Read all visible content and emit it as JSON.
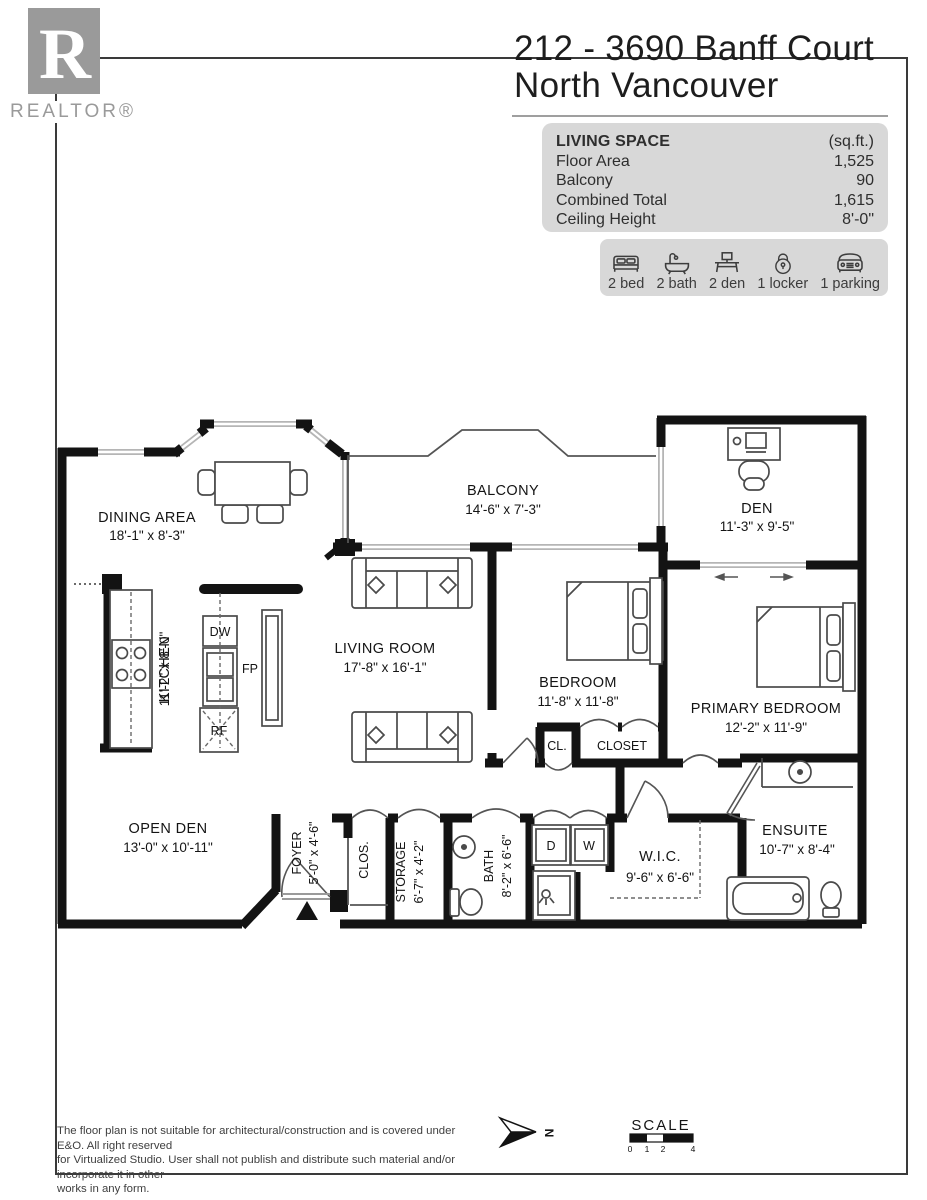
{
  "logo": {
    "text": "REALTOR®",
    "letter": "R"
  },
  "header": {
    "title_line1": "212 - 3690 Banff Court",
    "title_line2": "North Vancouver"
  },
  "living_space": {
    "title": "LIVING SPACE",
    "unit": "(sq.ft.)",
    "rows": [
      {
        "label": "Floor Area",
        "value": "1,525"
      },
      {
        "label": "Balcony",
        "value": "90"
      },
      {
        "label": "Combined Total",
        "value": "1,615"
      },
      {
        "label": "Ceiling Height",
        "value": "8'-0\""
      }
    ]
  },
  "features": [
    {
      "icon": "bed-icon",
      "label": "2 bed"
    },
    {
      "icon": "bath-icon",
      "label": "2 bath"
    },
    {
      "icon": "den-icon",
      "label": "2 den"
    },
    {
      "icon": "locker-icon",
      "label": "1 locker"
    },
    {
      "icon": "parking-icon",
      "label": "1 parking"
    }
  ],
  "rooms": {
    "dining": {
      "name": "DINING AREA",
      "dims": "18'-1\" x 8'-3\""
    },
    "balcony": {
      "name": "BALCONY",
      "dims": "14'-6\" x 7'-3\""
    },
    "den": {
      "name": "DEN",
      "dims": "11'-3\" x 9'-5\""
    },
    "living": {
      "name": "LIVING ROOM",
      "dims": "17'-8\" x 16'-1\""
    },
    "kitchen": {
      "name": "KITCHEN",
      "dims": "11'-2\" x 8'-0\""
    },
    "bedroom": {
      "name": "BEDROOM",
      "dims": "11'-8\" x 11'-8\""
    },
    "primary": {
      "name": "PRIMARY BEDROOM",
      "dims": "12'-2\" x 11'-9\""
    },
    "open_den": {
      "name": "OPEN DEN",
      "dims": "13'-0\" x 10'-11\""
    },
    "foyer": {
      "name": "FOYER",
      "dims": "5'-0\" x 4'-6\""
    },
    "clos": {
      "name": "CLOS."
    },
    "storage": {
      "name": "STORAGE",
      "dims": "6'-7\" x 4'-2\""
    },
    "bath": {
      "name": "BATH",
      "dims": "8'-2\" x 6'-6\""
    },
    "wic": {
      "name": "W.I.C.",
      "dims": "9'-6\" x 6'-6\""
    },
    "ensuite": {
      "name": "ENSUITE",
      "dims": "10'-7\" x 8'-4\""
    },
    "cl": {
      "name": "CL."
    },
    "closet": {
      "name": "CLOSET"
    }
  },
  "appliances": {
    "dw": "DW",
    "rf": "RF",
    "fp": "FP",
    "dryer": "D",
    "washer": "W"
  },
  "compass": {
    "north": "N"
  },
  "scale_bar": {
    "title": "SCALE",
    "ticks": [
      "0",
      "1",
      "2",
      "4"
    ]
  },
  "disclaimer": {
    "line1": "The floor plan is not suitable for architectural/construction and is covered under E&O. All right reserved",
    "line2": "for Virtualized Studio. User shall not publish and distribute such material and/or incorporate it in other",
    "line3": "works in any form."
  }
}
